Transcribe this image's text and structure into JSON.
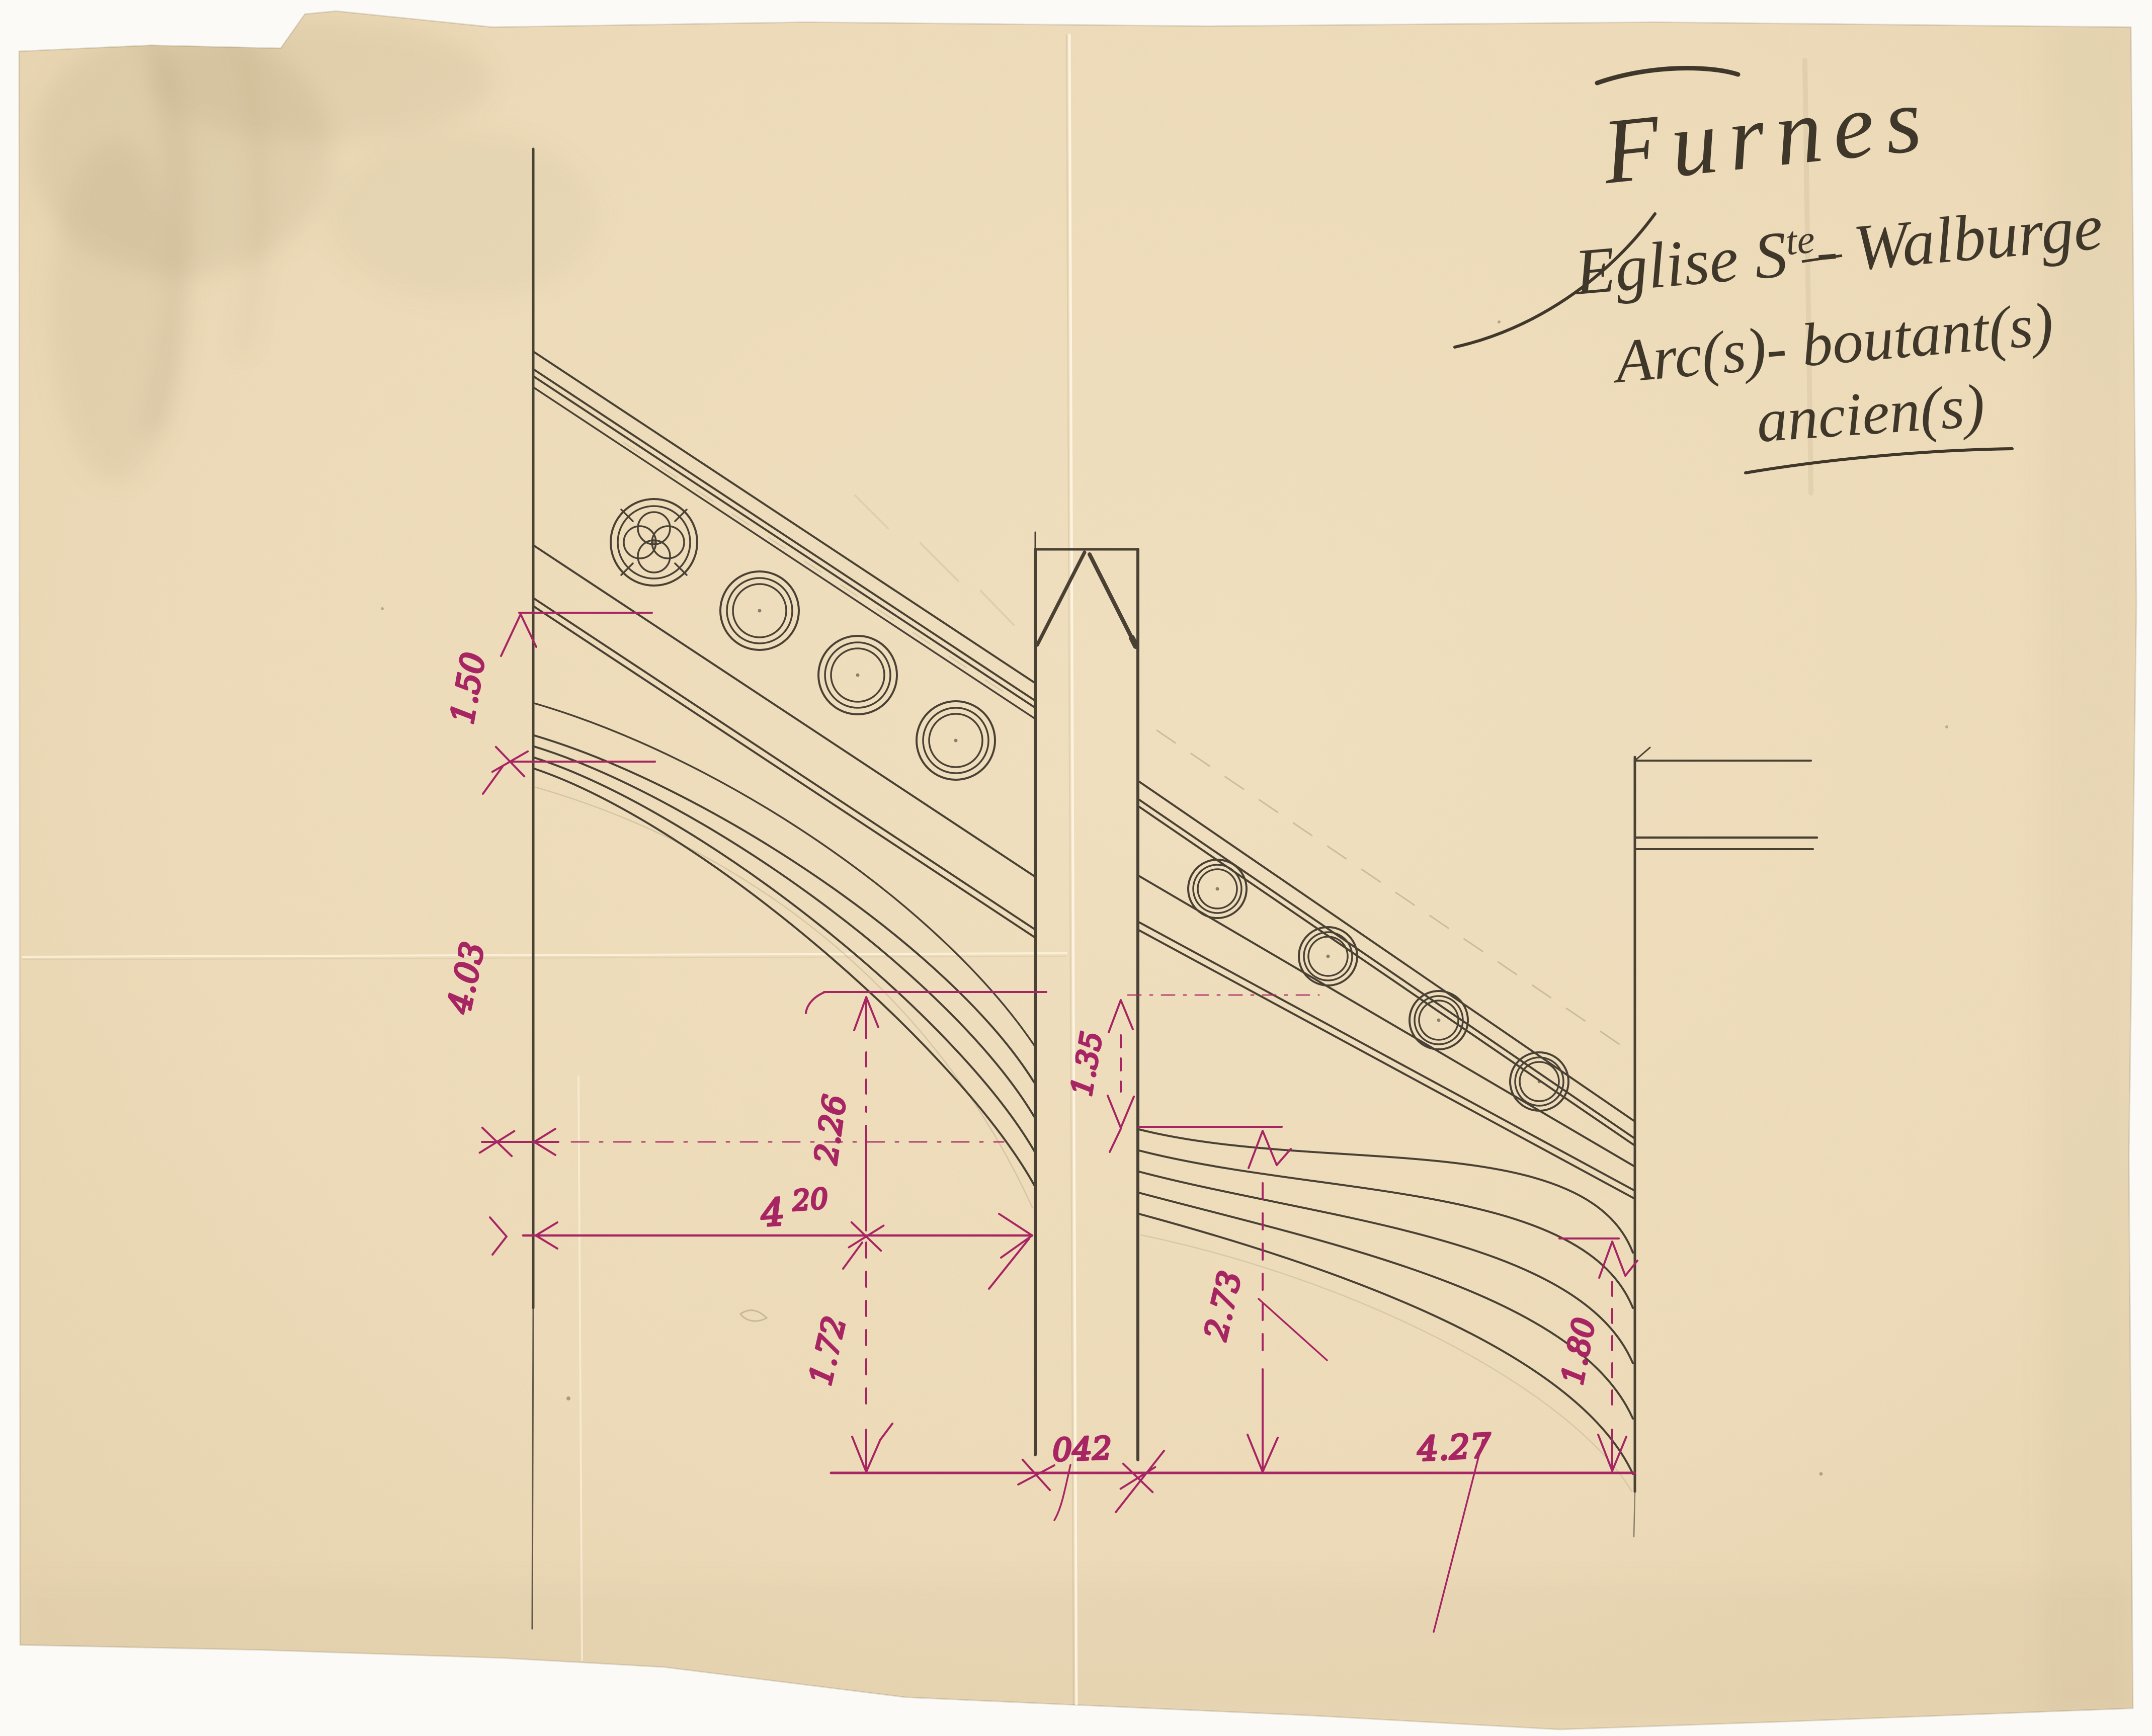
{
  "title_block": {
    "city": "Furnes",
    "building_prefix": "Eglise S",
    "building_sup": "te",
    "building_suffix": "- Walburge",
    "subject_line1": "Arc(s)- boutant(s)",
    "subject_line2": "ancien(s)"
  },
  "dimensions": {
    "left_wall_upper": "1.50",
    "left_wall_lower": "4.03",
    "left_span_int": "4",
    "left_span_sup": "20",
    "left_arch_rise": "2.26",
    "left_below_arch": "1.72",
    "pier_band_gap": "1.35",
    "pier_width": "042",
    "right_arch_rise": "2.73",
    "right_span": "4.27",
    "right_wall_height": "1.80"
  },
  "colors": {
    "paper": "#eedcba",
    "ink": "#4a4135",
    "dimension_ink": "#a72563",
    "handwriting_ink": "#3e372a",
    "pencil": "#a99a7b"
  }
}
